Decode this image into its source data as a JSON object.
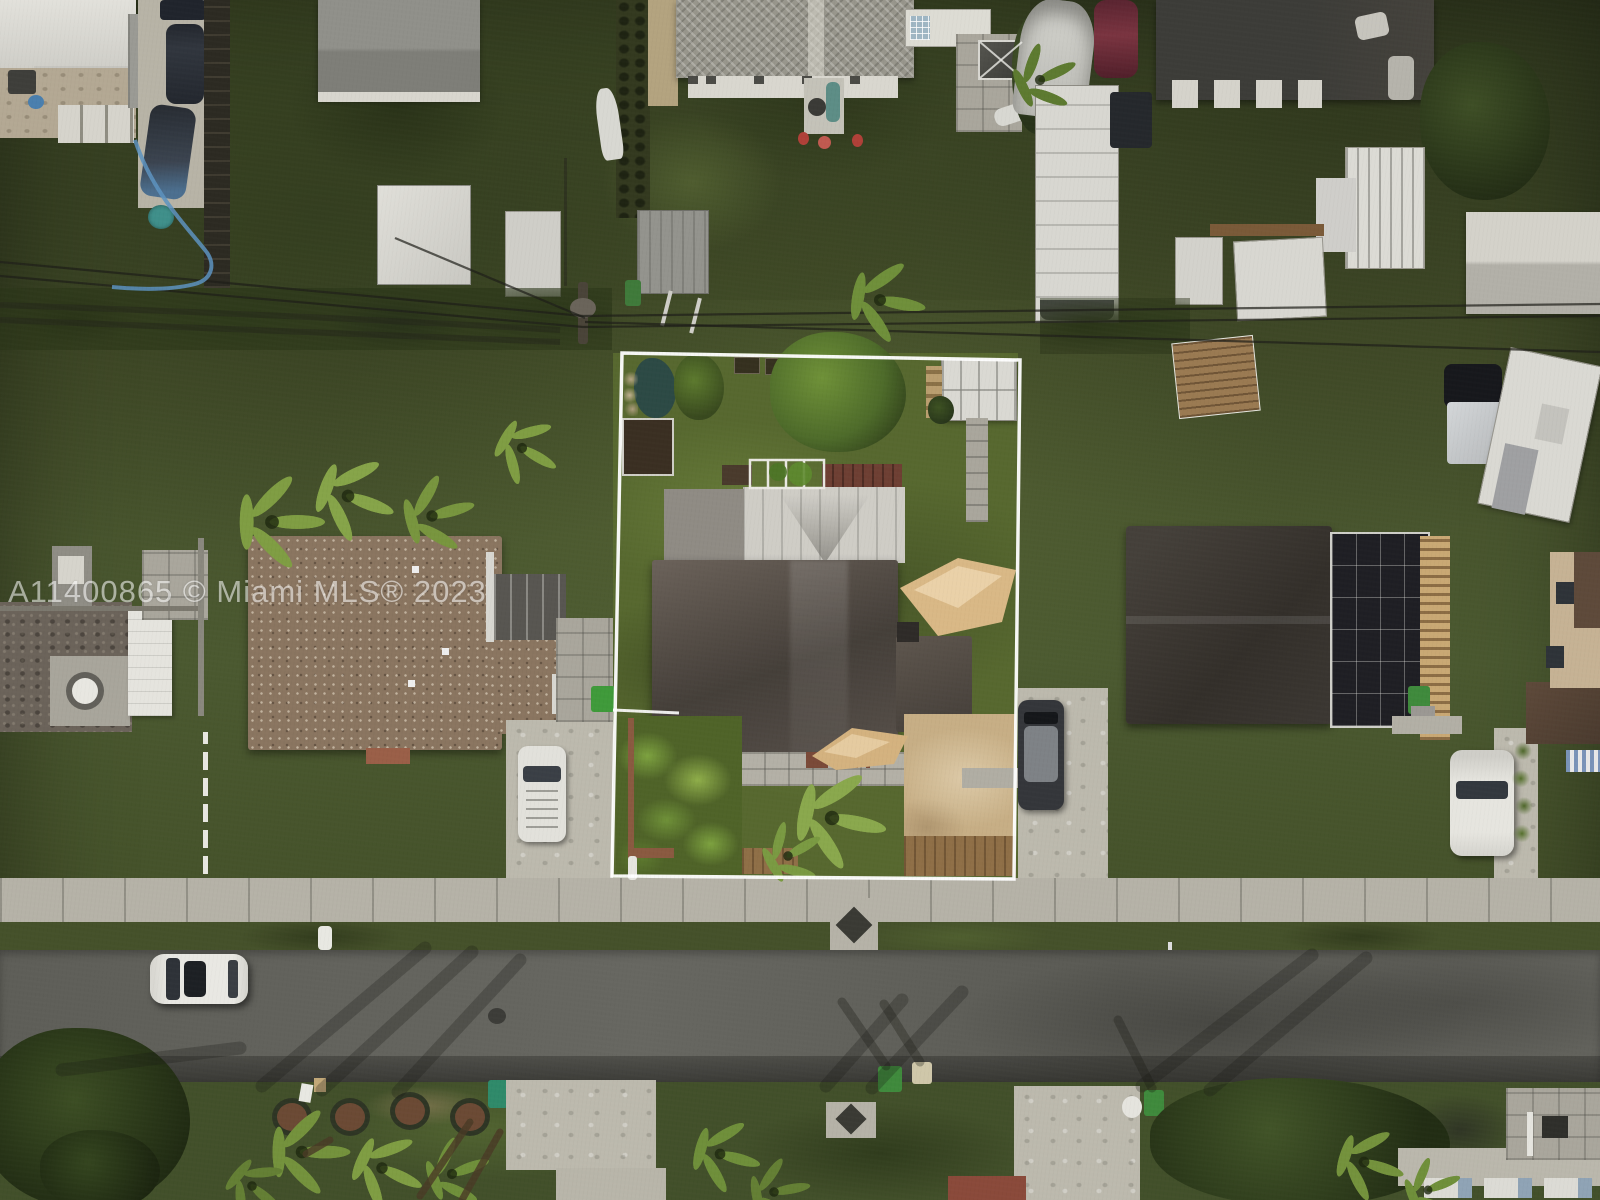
{
  "photo": {
    "kind": "aerial-drone-real-estate-photo",
    "subject": "residential lot outlined in white, Miami neighborhood"
  },
  "watermark": {
    "text": "A11400865 © Miami MLS® 2023",
    "color": "#ffffff",
    "opacity": 0.55
  },
  "lot_outline": {
    "color": "#ffffff",
    "shape": "quadrilateral around subject property"
  },
  "palette": {
    "grass_base": "#46512b",
    "grass_bright": "#6f8f3a",
    "asphalt": "#62625c",
    "sidewalk": "#b5b2a7",
    "concrete": "#c2bfb3",
    "dirt_tan": "#c7ae85",
    "subject_roof_dark": "#4a433d",
    "neighbor_roof_brown": "#8a7560",
    "neighbor_roof_charcoal": "#39352f",
    "white_roof": "#dcdbd5",
    "shade_sail": "#d9b886",
    "pond_teal": "#2c4a45",
    "palm_green": "#7f9d43",
    "tree_dark": "#2f3d22",
    "trash_bin_green": "#3f8a3c"
  },
  "features": {
    "street": "asphalt road along bottom with parked white car, manhole, palm shadows",
    "subject_lot": "white outline, dark-roof house, two tan shade sails, white shed, pond, garden, front palm",
    "left_neighbor": "brown shingle roof house, white van on driveway, patio, palms",
    "right_neighbor": "charcoal hip roof with screened pool cage, white SUV, pickup truck, white trailer",
    "top_row": "mobile homes, RVs, boats, sheds along rear alley with power lines"
  }
}
